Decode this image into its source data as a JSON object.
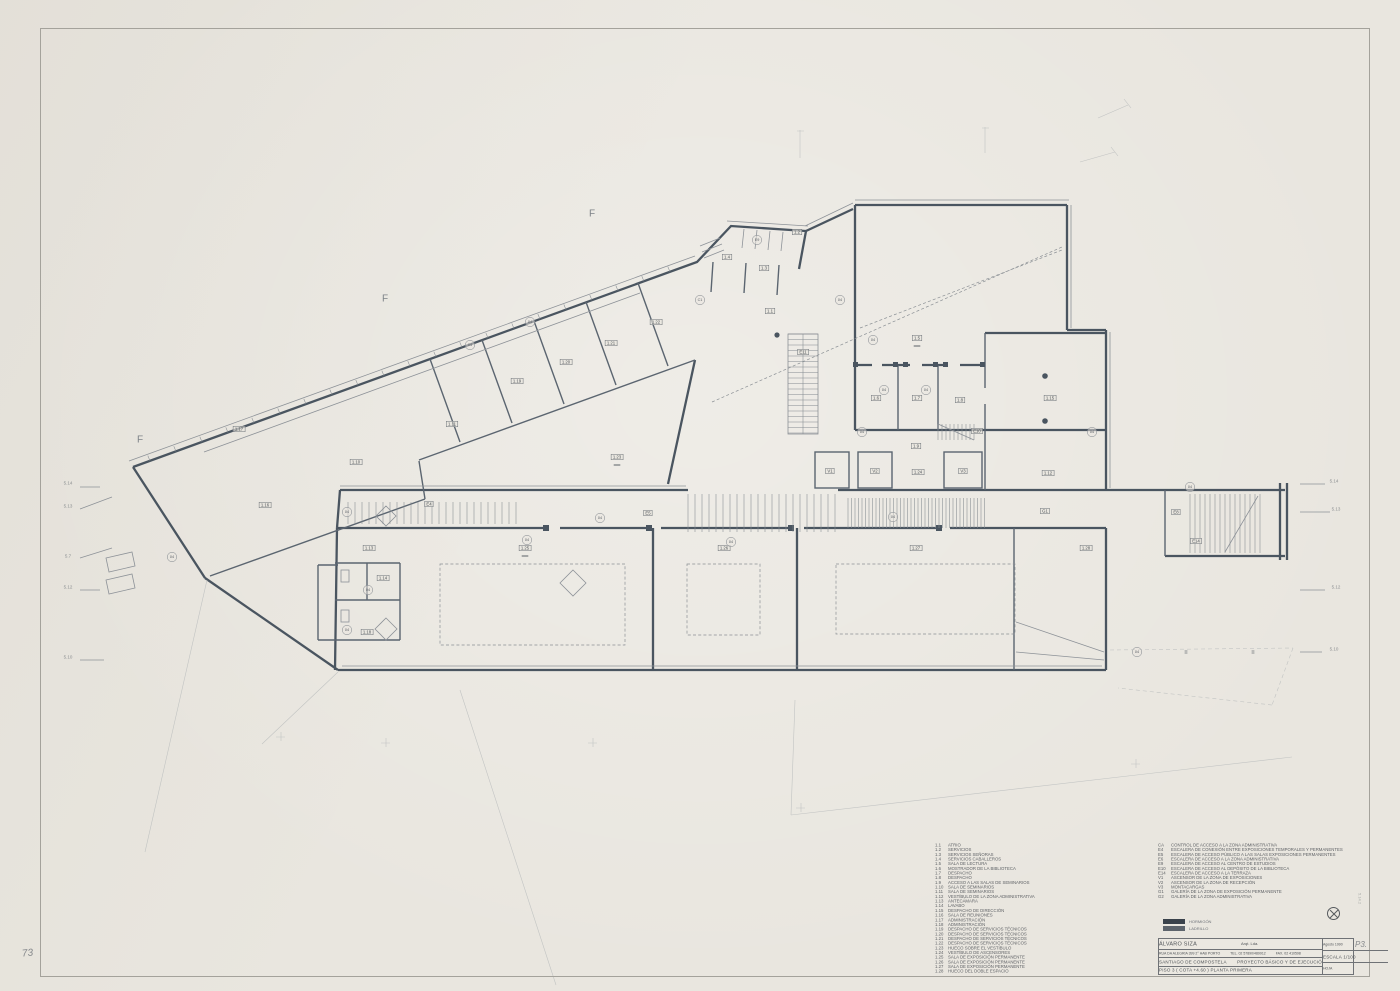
{
  "sheet": {
    "corner_page_number": "73",
    "plate_note": "P3.",
    "margin_note": "5.14.2"
  },
  "legend_left": {
    "items": [
      {
        "code": "1.1",
        "label": "ATRIO"
      },
      {
        "code": "1.2",
        "label": "SERVICIOS"
      },
      {
        "code": "1.3",
        "label": "SERVICIOS SEÑORAS"
      },
      {
        "code": "1.4",
        "label": "SERVICIOS CABALLEROS"
      },
      {
        "code": "1.5",
        "label": "SALA DE LECTURA"
      },
      {
        "code": "1.6",
        "label": "MOSTRADOR DE LA BIBLIOTECA"
      },
      {
        "code": "1.7",
        "label": "DESPACHO"
      },
      {
        "code": "1.8",
        "label": "DESPACHO"
      },
      {
        "code": "1.9",
        "label": "ACCESO A LAS SALAS DE SEMINARIOS"
      },
      {
        "code": "1.10",
        "label": "SALA DE SEMINARIOS"
      },
      {
        "code": "1.11",
        "label": "SALA DE SEMINARIOS"
      },
      {
        "code": "1.12",
        "label": "VESTÍBULO DE LA ZONA ADMINISTRATIVA"
      },
      {
        "code": "1.13",
        "label": "ANTECÁMARA"
      },
      {
        "code": "1.14",
        "label": "LAVABO"
      },
      {
        "code": "1.15",
        "label": "DESPACHO DE DIRECCIÓN"
      },
      {
        "code": "1.16",
        "label": "SALA DE REUNIONES"
      },
      {
        "code": "1.17",
        "label": "ADMINISTRACIÓN"
      },
      {
        "code": "1.18",
        "label": "ADMINISTRACIÓN"
      },
      {
        "code": "1.19",
        "label": "DESPACHO DE SERVICIOS TÉCNICOS"
      },
      {
        "code": "1.20",
        "label": "DESPACHO DE SERVICIOS TÉCNICOS"
      },
      {
        "code": "1.21",
        "label": "DESPACHO DE SERVICIOS TÉCNICOS"
      },
      {
        "code": "1.22",
        "label": "DESPACHO DE SERVICIOS TÉCNICOS"
      },
      {
        "code": "1.23",
        "label": "HUECO SOBRE EL VESTÍBULO"
      },
      {
        "code": "1.24",
        "label": "VESTÍBULO DE ASCENSORES"
      },
      {
        "code": "1.25",
        "label": "SALA DE EXPOSICIÓN PERMANENTE"
      },
      {
        "code": "1.26",
        "label": "SALA DE EXPOSICIÓN PERMANENTE"
      },
      {
        "code": "1.27",
        "label": "SALA DE EXPOSICIÓN PERMANENTE"
      },
      {
        "code": "1.28",
        "label": "HUECO DEL DOBLE  ESPACIO"
      }
    ]
  },
  "legend_right": {
    "items": [
      {
        "code": "CA",
        "label": "CONTROL DE ACCESO A LA ZONA ADMINISTRATIVA"
      },
      {
        "code": "E4",
        "label": "ESCALERA DE CONEXIÓN ENTRE EXPOSICIONES TEMPORALES Y PERMANENTES"
      },
      {
        "code": "E5",
        "label": "ESCALERA DE ACCESO PÚBLICO A LAS SALAS EXPOSICIONES PERMANENTES"
      },
      {
        "code": "E6",
        "label": "ESCALERA DE ACCESO A LA ZONA ADMINISTRATIVA"
      },
      {
        "code": "E9",
        "label": "ESCALERA DE ACCESO AL CENTRO DE ESTUDIOS"
      },
      {
        "code": "E10",
        "label": "ESCALERA DE ACCESO AL DEPÓSITO DE LA BIBLIOTECA"
      },
      {
        "code": "E14",
        "label": "ESCALERA DE ACCESO A LA TERRAZA"
      },
      {
        "code": "V1",
        "label": "ASCENSOR DE LA ZONA DE EXPOSICIONES"
      },
      {
        "code": "V2",
        "label": "ASCENSOR DE LA ZONA DE RECEPCIÓN"
      },
      {
        "code": "V3",
        "label": "MONTACARGAS"
      },
      {
        "code": "G1",
        "label": "GALERÍA DE LA ZONA DE EXPOSICIÓN PERMANENTE"
      },
      {
        "code": "G2",
        "label": "GALERÍA DE LA ZONA ADMINISTRATIVA"
      }
    ]
  },
  "materials_legend": {
    "items": [
      {
        "name": "HORMIGÓN",
        "color": "#3a424b"
      },
      {
        "name": "LADRILLO",
        "color": "#5d646c"
      }
    ]
  },
  "title_block": {
    "architect": "ÁLVARO SIZA",
    "architect_suffix": "Arqt. Lda.",
    "address": "RUA DA ALEGRIA 399 2° HAB PORTO",
    "tel": "TEL. 02 57890/489912",
    "fax": "FAX. 02 410598",
    "project_location": "SANTIAGO DE COMPOSTELA",
    "project_title": "PROYECTO BÁSICO Y DE EJECUCIÓN",
    "sheet_title": "PISO 3  ( COTA +4.60 )   PLANTA PRIMERA",
    "date_value": "Agosto 1990",
    "scale_label": "ESCALA",
    "scale_value": "1/100",
    "sheet_label": "HOJA"
  },
  "plan": {
    "boxed_labels": [
      {
        "t": "1.2",
        "x": 797,
        "y": 232
      },
      {
        "t": "1.3",
        "x": 764,
        "y": 268
      },
      {
        "t": "1.4",
        "x": 727,
        "y": 257
      },
      {
        "t": "1.1",
        "x": 770,
        "y": 311
      },
      {
        "t": "E11",
        "x": 803,
        "y": 352
      },
      {
        "t": "1.5",
        "x": 917,
        "y": 338,
        "h": 1
      },
      {
        "t": "1.6",
        "x": 876,
        "y": 398
      },
      {
        "t": "1.7",
        "x": 917,
        "y": 398
      },
      {
        "t": "1.8",
        "x": 960,
        "y": 400
      },
      {
        "t": "1.15",
        "x": 1050,
        "y": 398
      },
      {
        "t": "1.12",
        "x": 1048,
        "y": 473
      },
      {
        "t": "E10",
        "x": 977,
        "y": 431
      },
      {
        "t": "1.9",
        "x": 916,
        "y": 446
      },
      {
        "t": "1.24",
        "x": 918,
        "y": 472
      },
      {
        "t": "V1",
        "x": 830,
        "y": 471
      },
      {
        "t": "V2",
        "x": 875,
        "y": 471
      },
      {
        "t": "V3",
        "x": 963,
        "y": 471
      },
      {
        "t": "1.10",
        "x": 356,
        "y": 462
      },
      {
        "t": "1.11",
        "x": 452,
        "y": 424
      },
      {
        "t": "1.19",
        "x": 517,
        "y": 381
      },
      {
        "t": "1.20",
        "x": 566,
        "y": 362
      },
      {
        "t": "1.21",
        "x": 611,
        "y": 343
      },
      {
        "t": "1.22",
        "x": 656,
        "y": 322
      },
      {
        "t": "1.17",
        "x": 239,
        "y": 429
      },
      {
        "t": "1.16",
        "x": 265,
        "y": 505
      },
      {
        "t": "1.23",
        "x": 617,
        "y": 457,
        "h": 1
      },
      {
        "t": "1.13",
        "x": 369,
        "y": 548
      },
      {
        "t": "1.14",
        "x": 383,
        "y": 578
      },
      {
        "t": "1.18",
        "x": 367,
        "y": 632
      },
      {
        "t": "1.25",
        "x": 525,
        "y": 548,
        "h": 1
      },
      {
        "t": "1.26",
        "x": 724,
        "y": 548
      },
      {
        "t": "1.27",
        "x": 916,
        "y": 548
      },
      {
        "t": "1.28",
        "x": 1086,
        "y": 548
      },
      {
        "t": "G1",
        "x": 1045,
        "y": 511
      },
      {
        "t": "E4",
        "x": 429,
        "y": 504
      },
      {
        "t": "E5",
        "x": 648,
        "y": 513
      },
      {
        "t": "E8",
        "x": 1176,
        "y": 512
      },
      {
        "t": "E14",
        "x": 1196,
        "y": 541
      }
    ],
    "circle_labels": [
      {
        "t": "04",
        "x": 172,
        "y": 557
      },
      {
        "t": "04",
        "x": 347,
        "y": 512
      },
      {
        "t": "04",
        "x": 368,
        "y": 590
      },
      {
        "t": "04",
        "x": 347,
        "y": 630
      },
      {
        "t": "04",
        "x": 527,
        "y": 540
      },
      {
        "t": "04",
        "x": 600,
        "y": 518
      },
      {
        "t": "04",
        "x": 731,
        "y": 542
      },
      {
        "t": "04",
        "x": 893,
        "y": 517
      },
      {
        "t": "04",
        "x": 1190,
        "y": 487
      },
      {
        "t": "04",
        "x": 1137,
        "y": 652
      },
      {
        "t": "E9",
        "x": 757,
        "y": 240
      },
      {
        "t": "04",
        "x": 840,
        "y": 300
      },
      {
        "t": "04",
        "x": 862,
        "y": 432
      },
      {
        "t": "C1",
        "x": 700,
        "y": 300
      },
      {
        "t": "04",
        "x": 884,
        "y": 390
      },
      {
        "t": "04",
        "x": 926,
        "y": 390
      },
      {
        "t": "04",
        "x": 873,
        "y": 340
      },
      {
        "t": "04",
        "x": 1092,
        "y": 432
      },
      {
        "t": "04",
        "x": 470,
        "y": 345
      },
      {
        "t": "04",
        "x": 530,
        "y": 322
      }
    ],
    "letter_markers": [
      {
        "t": "F",
        "x": 385,
        "y": 299
      },
      {
        "t": "F",
        "x": 592,
        "y": 214
      },
      {
        "t": "F",
        "x": 140,
        "y": 440
      }
    ],
    "edge_labels": [
      {
        "t": "5.14",
        "x": 68,
        "y": 483
      },
      {
        "t": "5.13",
        "x": 68,
        "y": 506
      },
      {
        "t": "5.7",
        "x": 68,
        "y": 556
      },
      {
        "t": "5.12",
        "x": 68,
        "y": 587
      },
      {
        "t": "5.10",
        "x": 68,
        "y": 657
      },
      {
        "t": "5.14",
        "x": 1334,
        "y": 481
      },
      {
        "t": "5.13",
        "x": 1336,
        "y": 509
      },
      {
        "t": "5.12",
        "x": 1336,
        "y": 587
      },
      {
        "t": "5.10",
        "x": 1334,
        "y": 649
      }
    ],
    "tick_glyphs": [
      {
        "t": "≣",
        "x": 1186,
        "y": 652
      },
      {
        "t": "≣",
        "x": 1253,
        "y": 652
      }
    ]
  }
}
